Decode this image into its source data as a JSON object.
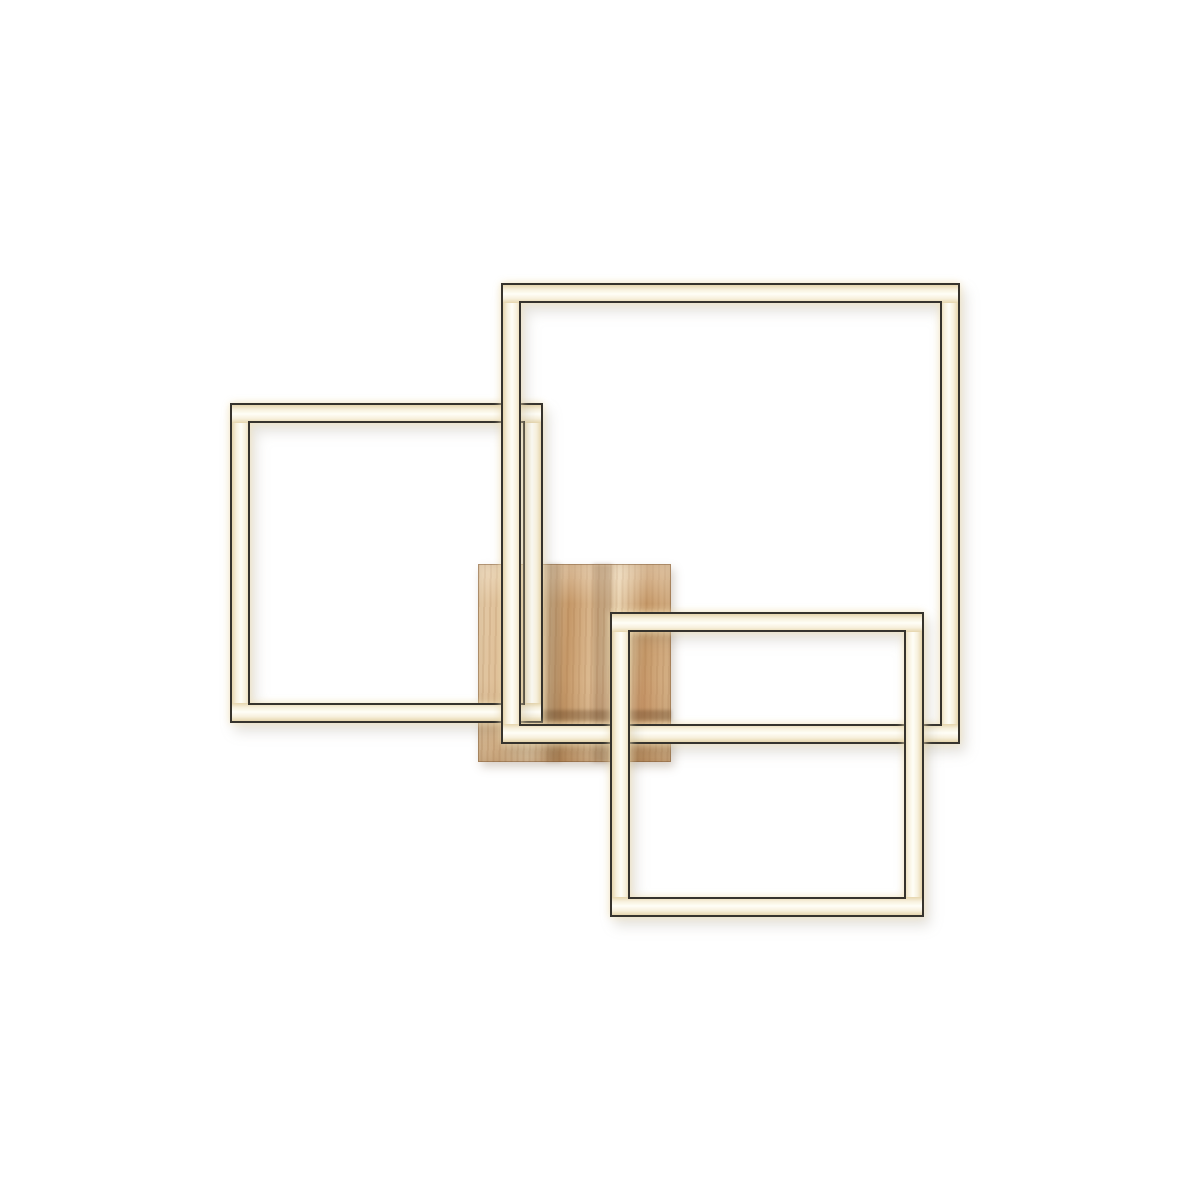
{
  "scene": {
    "description": "Product photo of a modern square LED ceiling lamp: three glowing square light frames overlapping a square natural-wood mounting plate on a plain white background.",
    "background_color": "#ffffff",
    "frame_style": {
      "band_thickness_px": 18,
      "outline_color": "#36332d",
      "led_edge_color": "#e6d6ae",
      "led_soft_color": "#f7f0dc",
      "led_center_color": "#fffef7",
      "glow_color": "#f4e4b8"
    },
    "wood_style": {
      "base_color": "#ddbb92",
      "light_color": "#e9d2b0",
      "dark_color": "#c59868",
      "shadow_color": "#63401f"
    },
    "elements": [
      {
        "name": "wood-mounting-plate",
        "x": 478,
        "y": 564,
        "w": 193,
        "h": 198,
        "z": 1
      },
      {
        "name": "led-frame-medium",
        "x": 232,
        "y": 405,
        "w": 309,
        "h": 316,
        "z": 2
      },
      {
        "name": "led-frame-large",
        "x": 503,
        "y": 285,
        "w": 455,
        "h": 457,
        "z": 3
      },
      {
        "name": "led-frame-small",
        "x": 612,
        "y": 614,
        "w": 310,
        "h": 301,
        "z": 4
      }
    ]
  }
}
